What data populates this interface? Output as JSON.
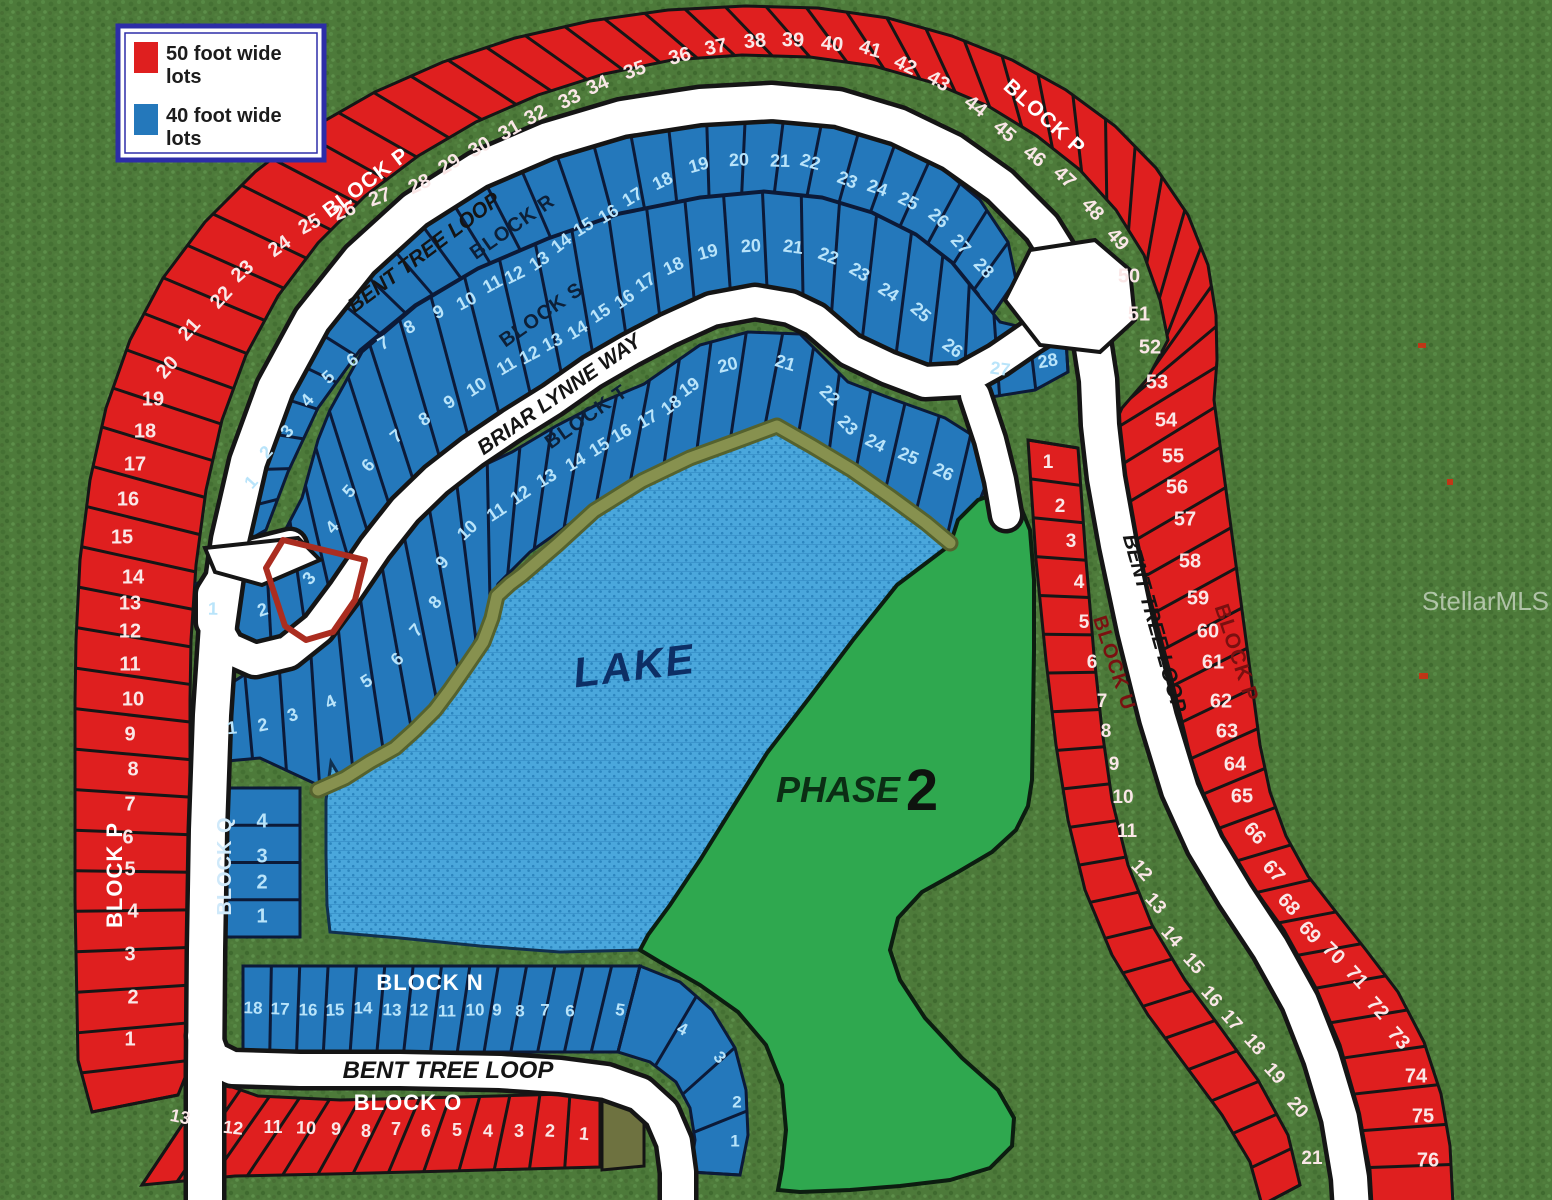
{
  "title": "Bent Tree subdivision plat map",
  "legend": {
    "items": [
      {
        "swatch": "#df1f1f",
        "lines": [
          "50 foot wide",
          "lots"
        ],
        "label": "50 foot wide lots"
      },
      {
        "swatch": "#2478bb",
        "lines": [
          "40 foot wide",
          "lots"
        ],
        "label": "40 foot wide lots"
      }
    ]
  },
  "watermark": "StellarMLS",
  "lake_label": "LAKE",
  "phase": {
    "word": "PHASE",
    "number": "2"
  },
  "roads": {
    "bent_tree_loop": "BENT TREE LOOP",
    "briar_lynne_way": "BRIAR LYNNE WAY"
  },
  "highlight": {
    "block": "S",
    "lot": "3"
  },
  "blocks": {
    "P": {
      "name": "BLOCK P",
      "color": "red",
      "lots": [
        "1",
        "2",
        "3",
        "4",
        "5",
        "6",
        "7",
        "8",
        "9",
        "10",
        "11",
        "12",
        "13",
        "14",
        "15",
        "16",
        "17",
        "18",
        "19",
        "20",
        "21",
        "22",
        "23",
        "24",
        "25",
        "26",
        "27",
        "28",
        "29",
        "30",
        "31",
        "32",
        "33",
        "34",
        "35",
        "36",
        "37",
        "38",
        "39",
        "40",
        "41",
        "42",
        "43",
        "44",
        "45",
        "46",
        "47",
        "48",
        "49",
        "50",
        "51",
        "52",
        "53",
        "54",
        "55",
        "56",
        "57",
        "58",
        "59",
        "60",
        "61",
        "62",
        "63",
        "64",
        "65",
        "66",
        "67",
        "68",
        "69",
        "70",
        "71",
        "72",
        "73",
        "74",
        "75",
        "76"
      ]
    },
    "R": {
      "name": "BLOCK R",
      "color": "blue",
      "lots": [
        "1",
        "2",
        "3",
        "4",
        "5",
        "6",
        "7",
        "8",
        "9",
        "10",
        "11",
        "12",
        "13",
        "14",
        "15",
        "16",
        "17",
        "18",
        "19",
        "20",
        "21",
        "22",
        "23",
        "24",
        "25",
        "26",
        "27",
        "28"
      ]
    },
    "S": {
      "name": "BLOCK S",
      "color": "blue",
      "lots": [
        "1",
        "2",
        "3",
        "4",
        "5",
        "6",
        "7",
        "8",
        "9",
        "10",
        "11",
        "12",
        "13",
        "14",
        "15",
        "16",
        "17",
        "18",
        "19",
        "20",
        "21",
        "22",
        "23",
        "24",
        "25",
        "26",
        "27",
        "28"
      ]
    },
    "T": {
      "name": "BLOCK T",
      "color": "blue",
      "lots": [
        "1",
        "2",
        "3",
        "4",
        "5",
        "6",
        "7",
        "8",
        "9",
        "10",
        "11",
        "12",
        "13",
        "14",
        "15",
        "16",
        "17",
        "18",
        "19",
        "20",
        "21",
        "22",
        "23",
        "24",
        "25",
        "26"
      ]
    },
    "U": {
      "name": "BLOCK U",
      "color": "red",
      "lots": [
        "1",
        "2",
        "3",
        "4",
        "5",
        "6",
        "7",
        "8",
        "9",
        "10",
        "11",
        "12",
        "13",
        "14",
        "15",
        "16",
        "17",
        "18",
        "19",
        "20",
        "21"
      ]
    },
    "Q": {
      "name": "BLOCK Q",
      "color": "blue",
      "lots": [
        "1",
        "2",
        "3",
        "4"
      ]
    },
    "N": {
      "name": "BLOCK N",
      "color": "blue",
      "lots": [
        "1",
        "2",
        "3",
        "4",
        "5",
        "6",
        "7",
        "8",
        "9",
        "10",
        "11",
        "12",
        "13",
        "14",
        "15",
        "16",
        "17",
        "18"
      ]
    },
    "O": {
      "name": "BLOCK O",
      "color": "red",
      "lots": [
        "1",
        "2",
        "3",
        "4",
        "5",
        "6",
        "7",
        "8",
        "9",
        "10",
        "11",
        "12",
        "13"
      ]
    }
  }
}
